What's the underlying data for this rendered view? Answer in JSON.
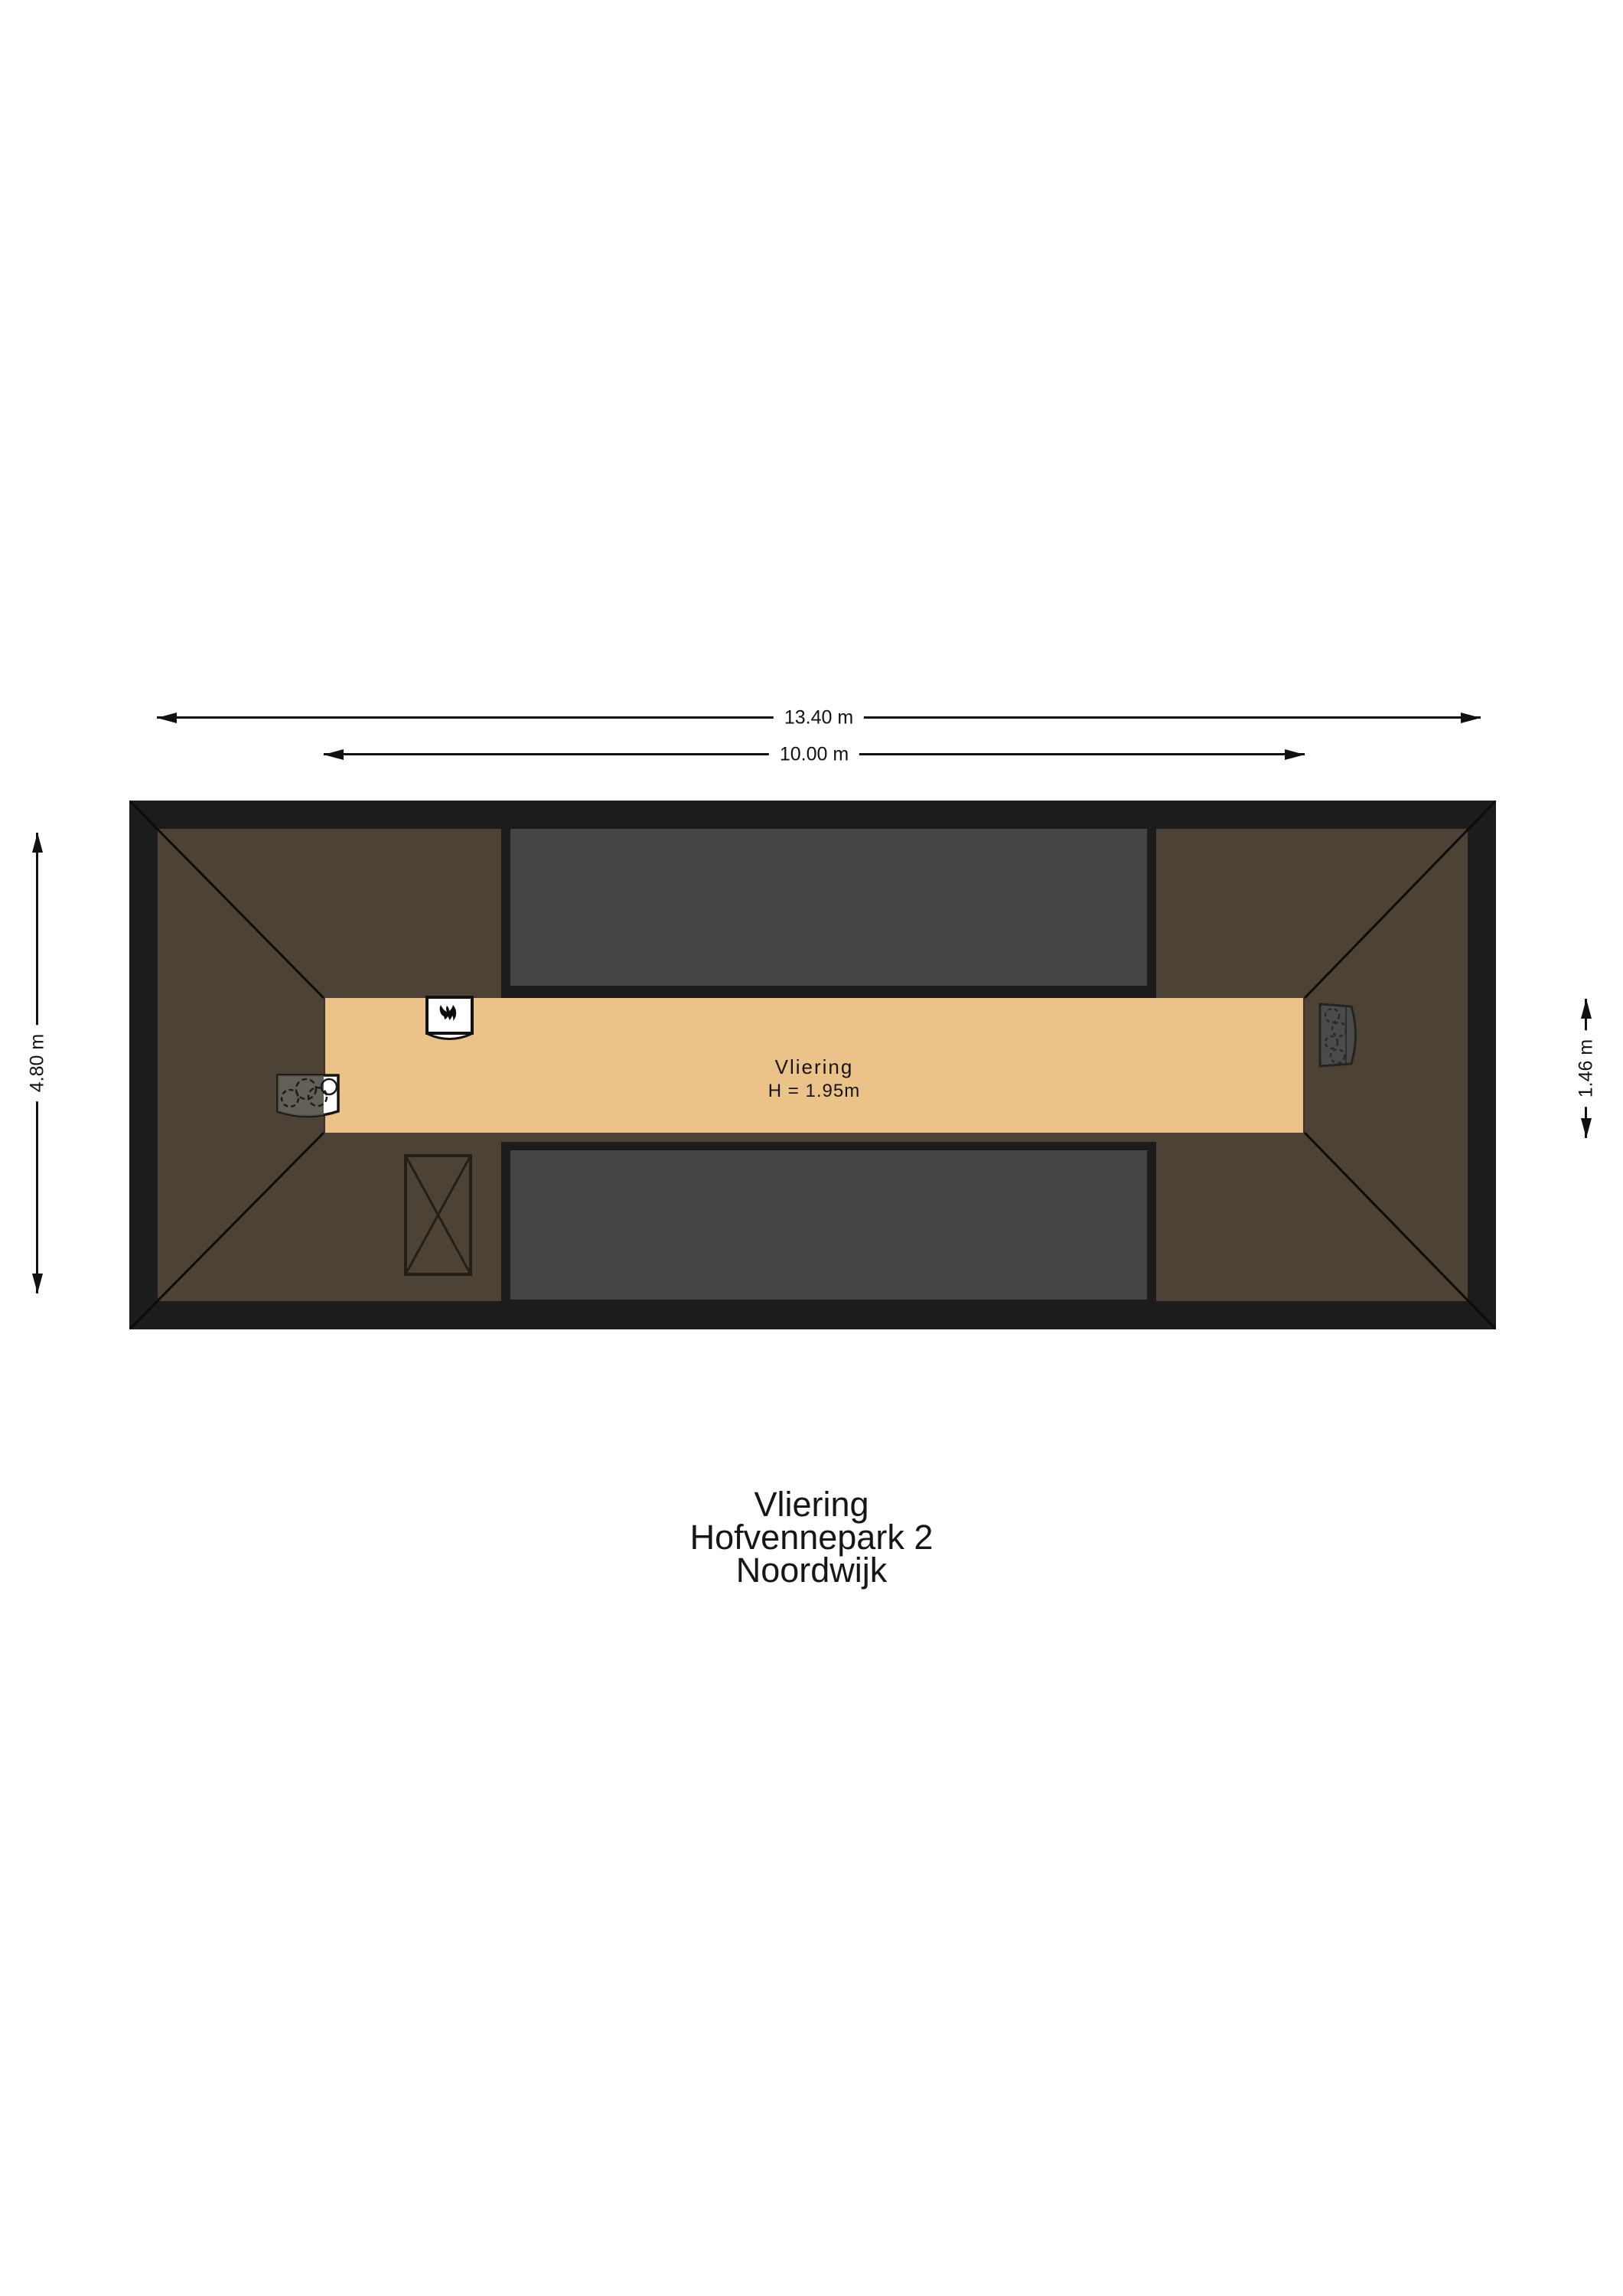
{
  "floorplan": {
    "room_label": "Vliering",
    "room_height_label": "H = 1.95m"
  },
  "dimensions": {
    "overall_width": "13.40 m",
    "floor_width": "10.00 m",
    "overall_depth": "4.80 m",
    "floor_depth": "1.46 m"
  },
  "title_block": {
    "lines": [
      "Vliering",
      "Hofvennepark 2",
      "Noordwijk"
    ]
  },
  "icons": {
    "boiler": "boiler-flame-icon",
    "hob": "hob-burners-icon",
    "shaft": "shaft-cross-icon",
    "vent": "vent-unit-icon"
  },
  "colors": {
    "background": "#ffffff",
    "wall": "#1c1c1c",
    "roof": "#4c4336",
    "floor": "#ebc388",
    "void": "#454546",
    "appliance": "#4b4b4b"
  }
}
